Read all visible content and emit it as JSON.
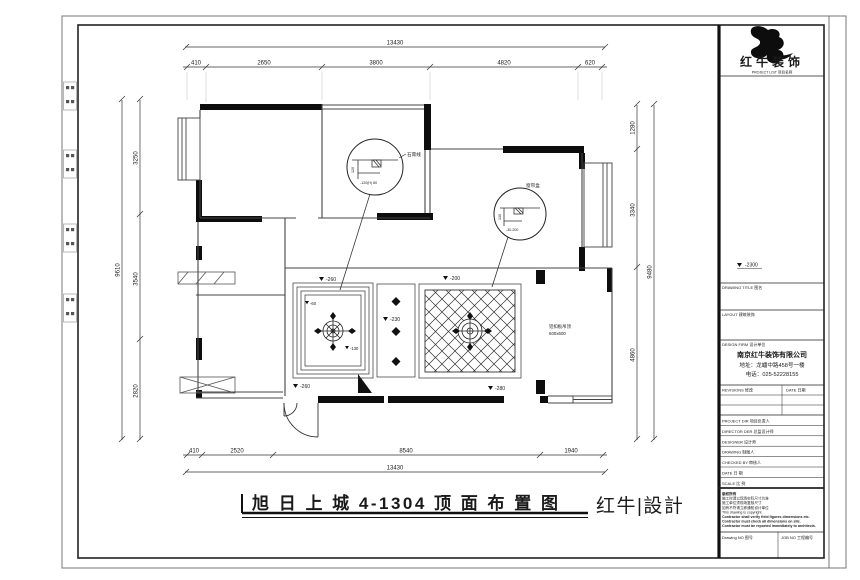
{
  "plan": {
    "dims": {
      "top_total": "13430",
      "top_segments": [
        "410",
        "2650",
        "3800",
        "4820",
        "620"
      ],
      "bottom_total": "13430",
      "bottom_segments": [
        "410",
        "2520",
        "8540",
        "1940"
      ],
      "left_total": "9610",
      "left_segments": [
        "3250",
        "3540",
        "2820"
      ],
      "right_total": "9480",
      "right_segments": [
        "1280",
        "3340",
        "4860"
      ]
    },
    "levels": {
      "dining_top": "-260",
      "dining_in1": "-60",
      "dining_in2": "-130",
      "dining_bottom": "-260",
      "hall": "-230",
      "living_top": "-200",
      "living_bottom": "-280"
    },
    "callout1": {
      "label": "石膏线",
      "dim_v": "120",
      "dim_h": "-120(H) 80"
    },
    "callout2": {
      "label": "窗帘盒",
      "dim_v": "130",
      "dim_h": "-30-200"
    },
    "note_right_line1": "铝扣板吊顶",
    "note_right_line2": "600x600",
    "title": "旭 日 上 城 4-1304 顶 面 布 置 图",
    "brand_mark": "红牛|設計"
  },
  "titleblock": {
    "logo_text": "红牛装饰",
    "project_list_label": "PROJECT LIST 项目名称",
    "elev_mark": "-2300",
    "drawing_title_label": "DRAWING TITLE 图名",
    "layout_label": "LAYOUT 建筑装饰",
    "design_firm_label": "DESIGN FIRM 设计单位",
    "firm_name": "南京红牛装饰有限公司",
    "firm_addr": "地址：龙蟠中路458号一楼",
    "firm_tel": "电话：025-52228155",
    "revisions_label": "REVISIONS 修改",
    "date_label": "DATE 日期",
    "staff_rows": [
      {
        "label": "PROJECT DIR 项目负责人",
        "value": ""
      },
      {
        "label": "DIRECTOR DER 总监设计师",
        "value": ""
      },
      {
        "label": "DESIGNER 设计师",
        "value": ""
      },
      {
        "label": "DRAWING 制图人",
        "value": ""
      },
      {
        "label": "CHECKED BY 审核人",
        "value": ""
      },
      {
        "label": "DATE 日 期",
        "value": ""
      },
      {
        "label": "SCALE 比 例",
        "value": ""
      }
    ],
    "notes": [
      "版权所有",
      "施工时请以现场实际尺寸为准",
      "施工单位须现场复核尺寸",
      "如有不符请立即通知设计单位",
      "This drawing is copyright.",
      "Contractor shall verify field figures dimensions etc.",
      "Contractor must check all dimensions on site.",
      "Contractor must be reported immediately to architects."
    ],
    "drawing_no_label": "Drawing NO 图号",
    "job_no_label": "JOB NO 工程编号"
  },
  "colors": {
    "brand_red": "#d98f8f",
    "line": "#1a1a1a"
  }
}
